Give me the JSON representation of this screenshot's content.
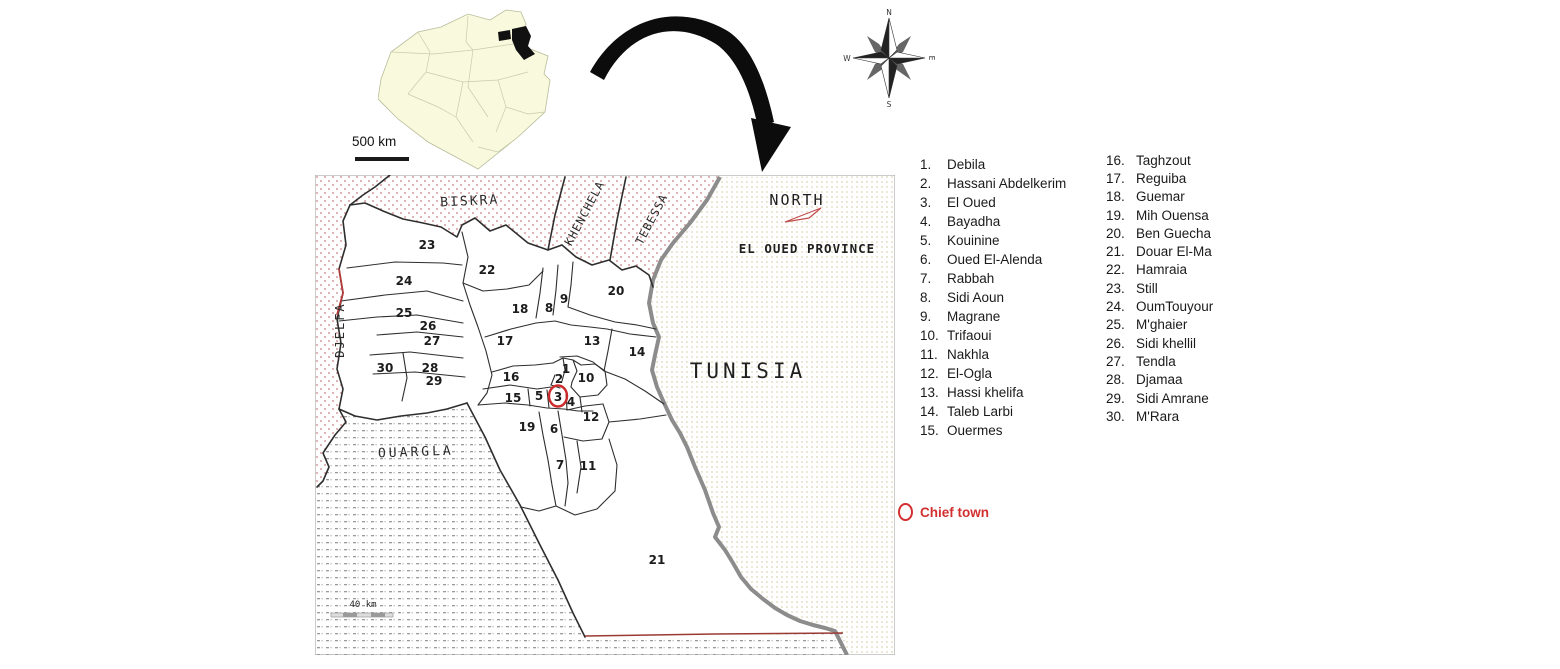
{
  "inset": {
    "scale_label": "500 km",
    "country": "Algeria outline with El Oued province highlighted"
  },
  "compass": {
    "n": "N",
    "s": "S",
    "w": "W",
    "e": "E"
  },
  "map": {
    "labels": {
      "north": "NORTH",
      "province": "EL OUED PROVINCE",
      "tunisia": "TUNISIA",
      "scale": "40 km"
    },
    "neighbor_labels": [
      {
        "text": "BISKRA",
        "x": 155,
        "y": 30,
        "rotate": -3,
        "size": 13,
        "spacing": 2
      },
      {
        "text": "KHENCHELA",
        "x": 273,
        "y": 40,
        "rotate": -62,
        "size": 11.5,
        "spacing": 1
      },
      {
        "text": "TEBESSA",
        "x": 340,
        "y": 46,
        "rotate": -62,
        "size": 11.5,
        "spacing": 1
      },
      {
        "text": "DJELFA",
        "x": 29,
        "y": 155,
        "rotate": -90,
        "size": 12,
        "spacing": 2
      },
      {
        "text": "OUARGLA",
        "x": 101,
        "y": 281,
        "rotate": -2,
        "size": 13,
        "spacing": 3
      }
    ],
    "districts": [
      {
        "n": 1,
        "x": 251,
        "y": 194
      },
      {
        "n": 2,
        "x": 244,
        "y": 204
      },
      {
        "n": 3,
        "x": 243,
        "y": 222
      },
      {
        "n": 4,
        "x": 256,
        "y": 227
      },
      {
        "n": 5,
        "x": 224,
        "y": 221
      },
      {
        "n": 6,
        "x": 239,
        "y": 254
      },
      {
        "n": 7,
        "x": 245,
        "y": 290
      },
      {
        "n": 8,
        "x": 234,
        "y": 133
      },
      {
        "n": 9,
        "x": 249,
        "y": 124
      },
      {
        "n": 10,
        "x": 271,
        "y": 203
      },
      {
        "n": 11,
        "x": 273,
        "y": 291
      },
      {
        "n": 12,
        "x": 276,
        "y": 242
      },
      {
        "n": 13,
        "x": 277,
        "y": 166
      },
      {
        "n": 14,
        "x": 322,
        "y": 177
      },
      {
        "n": 15,
        "x": 198,
        "y": 223
      },
      {
        "n": 16,
        "x": 196,
        "y": 202
      },
      {
        "n": 17,
        "x": 190,
        "y": 166
      },
      {
        "n": 18,
        "x": 205,
        "y": 134
      },
      {
        "n": 19,
        "x": 212,
        "y": 252
      },
      {
        "n": 20,
        "x": 301,
        "y": 116
      },
      {
        "n": 21,
        "x": 342,
        "y": 385
      },
      {
        "n": 22,
        "x": 172,
        "y": 95
      },
      {
        "n": 23,
        "x": 112,
        "y": 70
      },
      {
        "n": 24,
        "x": 89,
        "y": 106
      },
      {
        "n": 25,
        "x": 89,
        "y": 138
      },
      {
        "n": 26,
        "x": 113,
        "y": 151
      },
      {
        "n": 27,
        "x": 117,
        "y": 166
      },
      {
        "n": 28,
        "x": 115,
        "y": 193
      },
      {
        "n": 29,
        "x": 119,
        "y": 206
      },
      {
        "n": 30,
        "x": 70,
        "y": 193
      }
    ],
    "chief_town_district": 3
  },
  "legend": {
    "column1": [
      {
        "num": "1.",
        "name": "Debila"
      },
      {
        "num": "2.",
        "name": "Hassani Abdelkerim"
      },
      {
        "num": "3.",
        "name": "El Oued"
      },
      {
        "num": "4.",
        "name": "Bayadha"
      },
      {
        "num": "5.",
        "name": "Kouinine"
      },
      {
        "num": "6.",
        "name": "Oued El-Alenda"
      },
      {
        "num": "7.",
        "name": "Rabbah"
      },
      {
        "num": "8.",
        "name": "Sidi Aoun"
      },
      {
        "num": "9.",
        "name": "Magrane"
      },
      {
        "num": "10.",
        "name": "Trifaoui"
      },
      {
        "num": "11.",
        "name": "Nakhla"
      },
      {
        "num": "12.",
        "name": "El-Ogla"
      },
      {
        "num": "13.",
        "name": "Hassi khelifa"
      },
      {
        "num": "14.",
        "name": "Taleb Larbi"
      },
      {
        "num": "15.",
        "name": "Ouermes"
      }
    ],
    "column2": [
      {
        "num": "16.",
        "name": "Taghzout"
      },
      {
        "num": "17.",
        "name": "Reguiba"
      },
      {
        "num": "18.",
        "name": "Guemar"
      },
      {
        "num": "19.",
        "name": "Mih Ouensa"
      },
      {
        "num": "20.",
        "name": "Ben Guecha"
      },
      {
        "num": "21.",
        "name": "Douar El-Ma"
      },
      {
        "num": "22.",
        "name": "Hamraia"
      },
      {
        "num": "23.",
        "name": "Still"
      },
      {
        "num": "24.",
        "name": "OumTouyour"
      },
      {
        "num": "25.",
        "name": "M'ghaier"
      },
      {
        "num": "26.",
        "name": "Sidi khellil"
      },
      {
        "num": "27.",
        "name": "Tendla"
      },
      {
        "num": "28.",
        "name": "Djamaa"
      },
      {
        "num": "29.",
        "name": "Sidi Amrane"
      },
      {
        "num": "30.",
        "name": "M'Rara"
      }
    ],
    "chief_town_label": "Chief town"
  },
  "colors": {
    "stipple_red": "#c98080",
    "stipple_gray": "#9a9a9a",
    "stipple_tan": "#e7e0c6",
    "border_gray": "#8c8c8c",
    "accent_red": "#cc2a2a",
    "bottom_line_red": "#9b3a33",
    "inset_fill": "#f8f9dd"
  }
}
